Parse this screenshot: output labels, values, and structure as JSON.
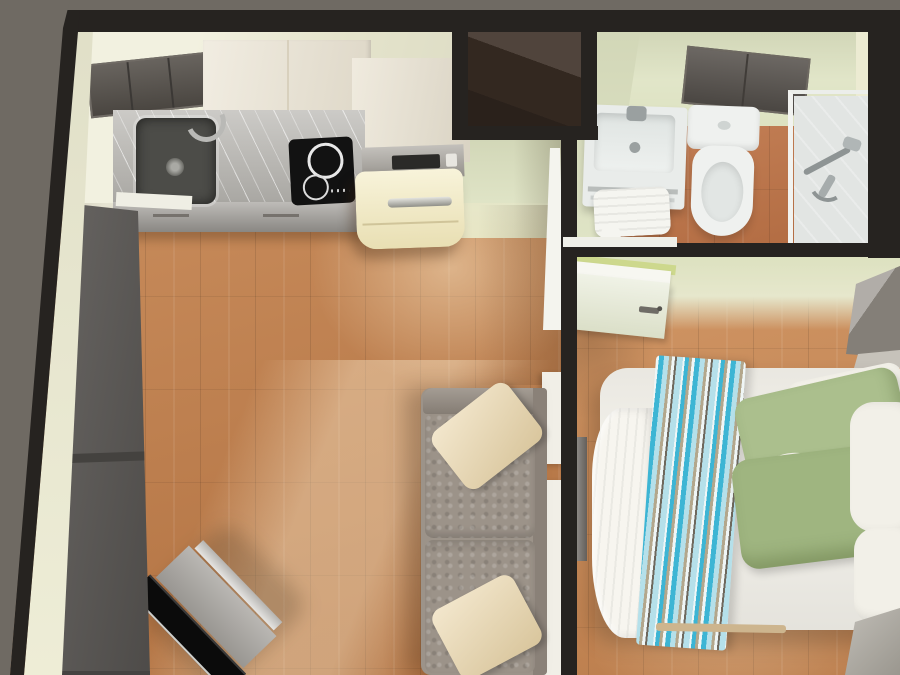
{
  "scene": {
    "description": "Top-down 3D render of a small studio apartment: kitchen, hallway, bathroom, living area and bedroom",
    "outside_color": "#6f6a63",
    "wall_color": "#262320",
    "wall_inner_color": "#ecebd2",
    "hall_wall_color": "#dde2c1",
    "bedroom_wall_color": "#dce1bf",
    "floor_color": "#bd7c4a",
    "bedroom_floor_color": "#c98a57",
    "bathroom_floor_color": "#bd744a",
    "shaft_color": "#3c2f26",
    "threshold_color": "#efefe8",
    "front_door_color": "#5d5a57"
  },
  "kitchen": {
    "upper_cabinets_dark_color": "#57524c",
    "upper_cabinets_cream_color": "#eae3d2",
    "countertop_color": "#bbb9b4",
    "counter_front_color": "#a8a5a0",
    "sink_color": "#4c4c48",
    "cooktop_color": "#121212",
    "fridge_color": "#f4edc6",
    "microwave_color": "#a9a59e"
  },
  "bathroom": {
    "vanity_color": "#e9ecea",
    "toilet_color": "#eff1ef",
    "towel_color": "#f5f5f0",
    "cabinet_color": "#5b5651",
    "shower_tray_color": "#e2e5e3",
    "fixture_metal_color": "#9aa0a0",
    "door_color": "#f4f4ee"
  },
  "bedroom": {
    "duvet_color": "#f3f1ea",
    "scrunched_duvet_color": "#f7f5ef",
    "pillow_green_color": "#abbf8d",
    "pillow_green_dark_color": "#9fb580",
    "pillow_white_color": "#f2f0e8",
    "throw_teal": "#3db5d4",
    "throw_blue": "#b5e0ea",
    "throw_tan": "#b3a78c",
    "throw_dark": "#6e685d",
    "throw_white": "#eff6f6",
    "door_color": "#ecefe0",
    "door_rail_color": "#f7f7f1",
    "door_accent_color": "#cdd88d",
    "wardrobe_color": "#8f8a82",
    "corner_unit_color": "#aca89f",
    "tv_panel_color": "#7b7874",
    "bed_frame_color": "#cdb58e"
  },
  "living": {
    "sofa_color": "#9c9389",
    "sofa_back_color": "#8a8178",
    "sofa_arm_color": "#948b81",
    "sofa_pillow_color": "#eeddb8",
    "console_color": "#f1efe7",
    "tv_screen_color": "#0b0b0b",
    "tv_stand_color": "#aaa7a2",
    "tv_trim_color": "#d5d3cf"
  }
}
